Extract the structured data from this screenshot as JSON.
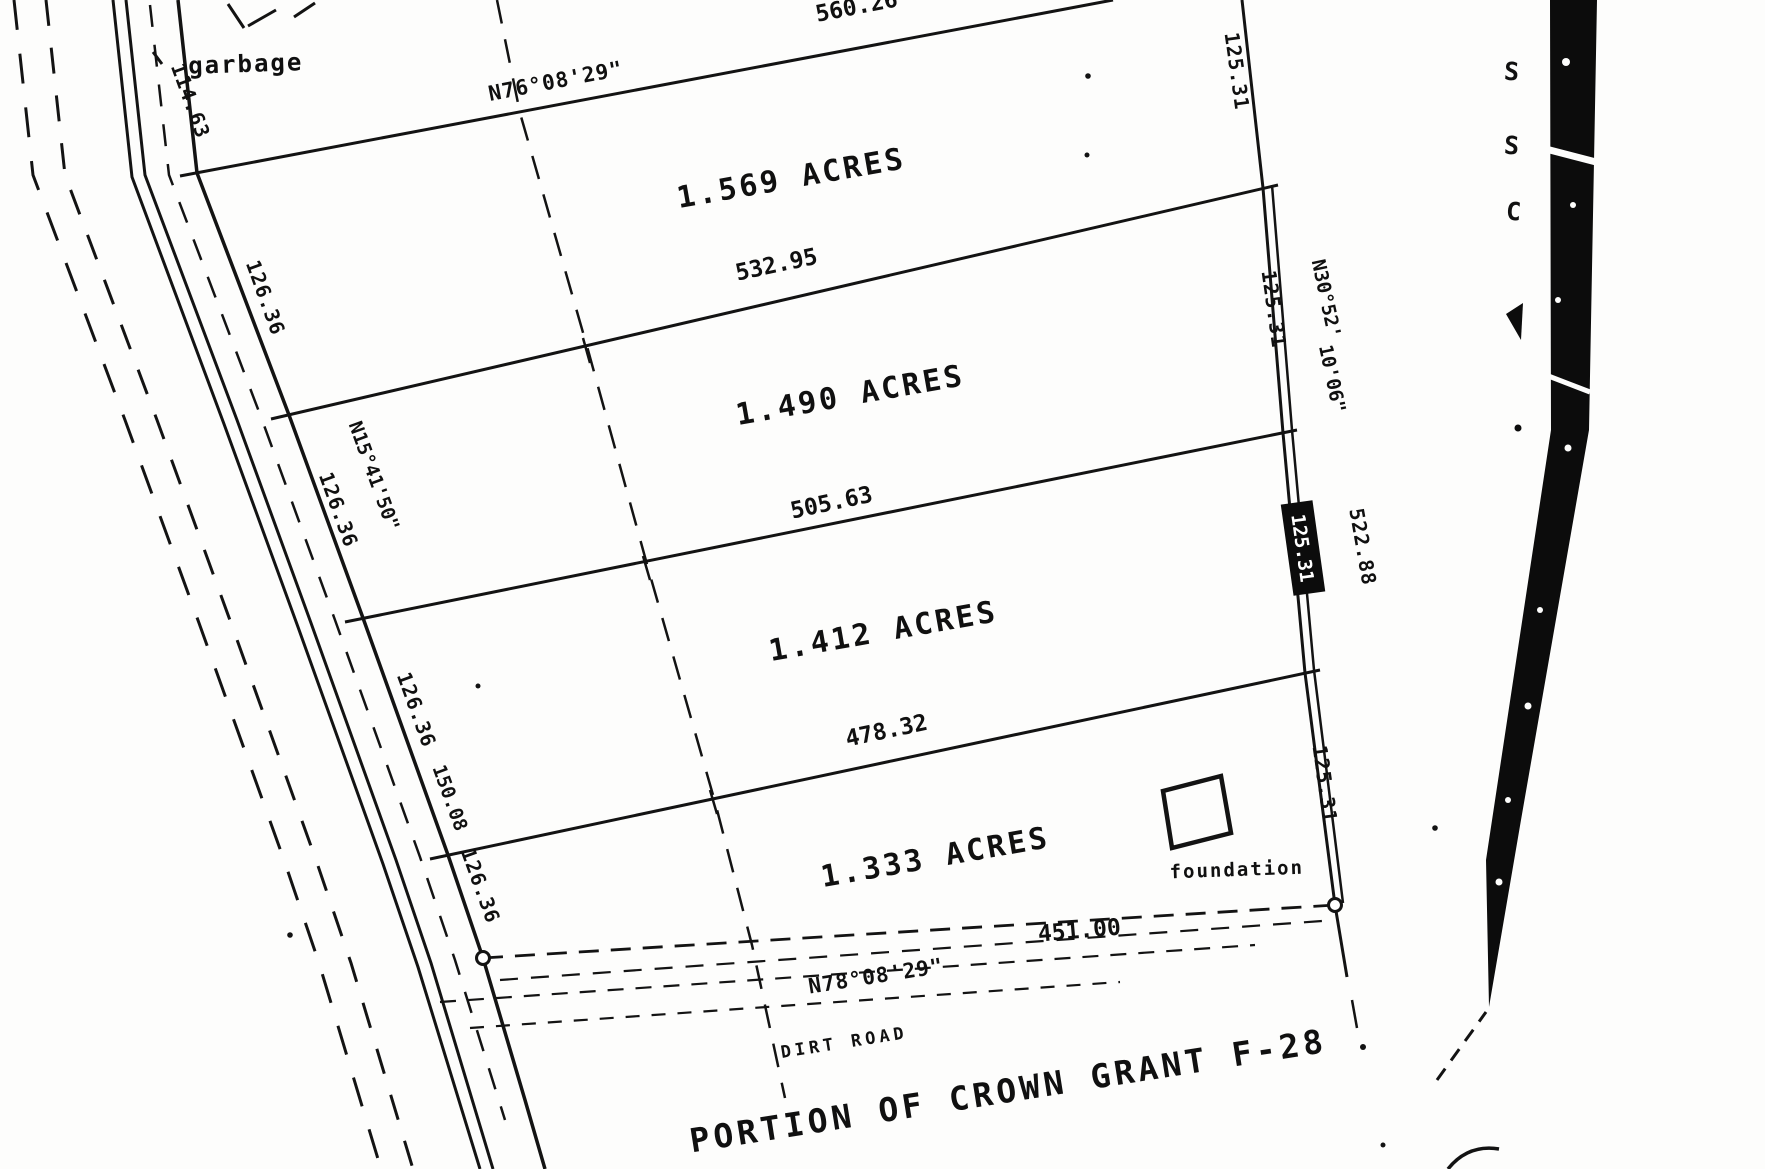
{
  "meta": {
    "description": "Scanned black-and-white land survey plat",
    "background": "#fdfdfc",
    "ink": "#131313"
  },
  "annotations": {
    "garbage": "garbage",
    "foundation_label": "foundation",
    "dirt_road": "DIRT ROAD",
    "title": "PORTION OF CROWN GRANT F-28"
  },
  "road": {
    "top_dim": "114.63",
    "frontage_dims": [
      "126.36",
      "126.36",
      "126.36",
      "126.36"
    ],
    "bearing": "N15°41'50\"",
    "extra_dim": "150.08"
  },
  "parcels": [
    {
      "acreage": "1.569 ACRES"
    },
    {
      "acreage": "1.490 ACRES"
    },
    {
      "acreage": "1.412 ACRES"
    },
    {
      "acreage": "1.333 ACRES"
    }
  ],
  "division_lines": {
    "north_dim": "560.26",
    "north_bearing": "N76°08'29\"",
    "dims": [
      "532.95",
      "505.63",
      "478.32"
    ],
    "south_dim": "451.00",
    "south_bearing": "N78°08'29\""
  },
  "east_boundary": {
    "segment_dims": [
      "125.31",
      "125.31",
      "125.31",
      "125.31"
    ],
    "total_dim": "522.88",
    "bearing_line1": "N30°52'",
    "bearing_line2": "10'06\""
  },
  "margin": {
    "letters": [
      "S",
      "S",
      "C"
    ]
  }
}
